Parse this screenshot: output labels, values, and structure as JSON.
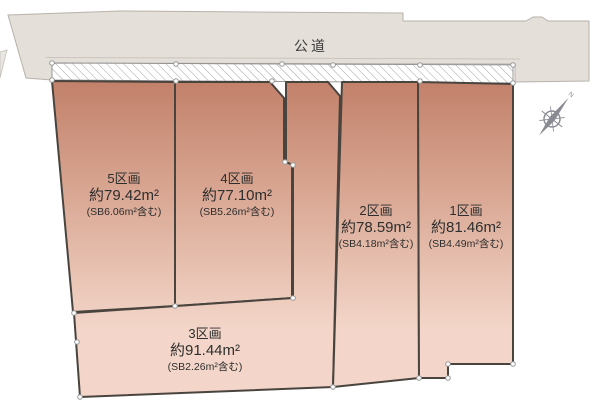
{
  "road": {
    "label": "公道"
  },
  "plots": [
    {
      "name": "1区画",
      "area": "約81.46m²",
      "sb": "(SB4.49m²含む)"
    },
    {
      "name": "2区画",
      "area": "約78.59m²",
      "sb": "(SB4.18m²含む)"
    },
    {
      "name": "3区画",
      "area": "約91.44m²",
      "sb": "(SB2.26m²含む)"
    },
    {
      "name": "4区画",
      "area": "約77.10m²",
      "sb": "(SB5.26m²含む)"
    },
    {
      "name": "5区画",
      "area": "約79.42m²",
      "sb": "(SB6.06m²含む)"
    }
  ],
  "compass": {
    "north_label": "N"
  },
  "colors": {
    "plot_fill_top": "#c2816a",
    "plot_fill_mid": "#d9a793",
    "plot_fill_bottom": "#f3d6c9",
    "road_fill": "#e4dfd9",
    "road_edge": "#b7b1aa",
    "plot_border": "#4a443f",
    "hatch_line": "#a0a0a0",
    "text": "#2e2e2e",
    "compass": "#8a8a93"
  }
}
